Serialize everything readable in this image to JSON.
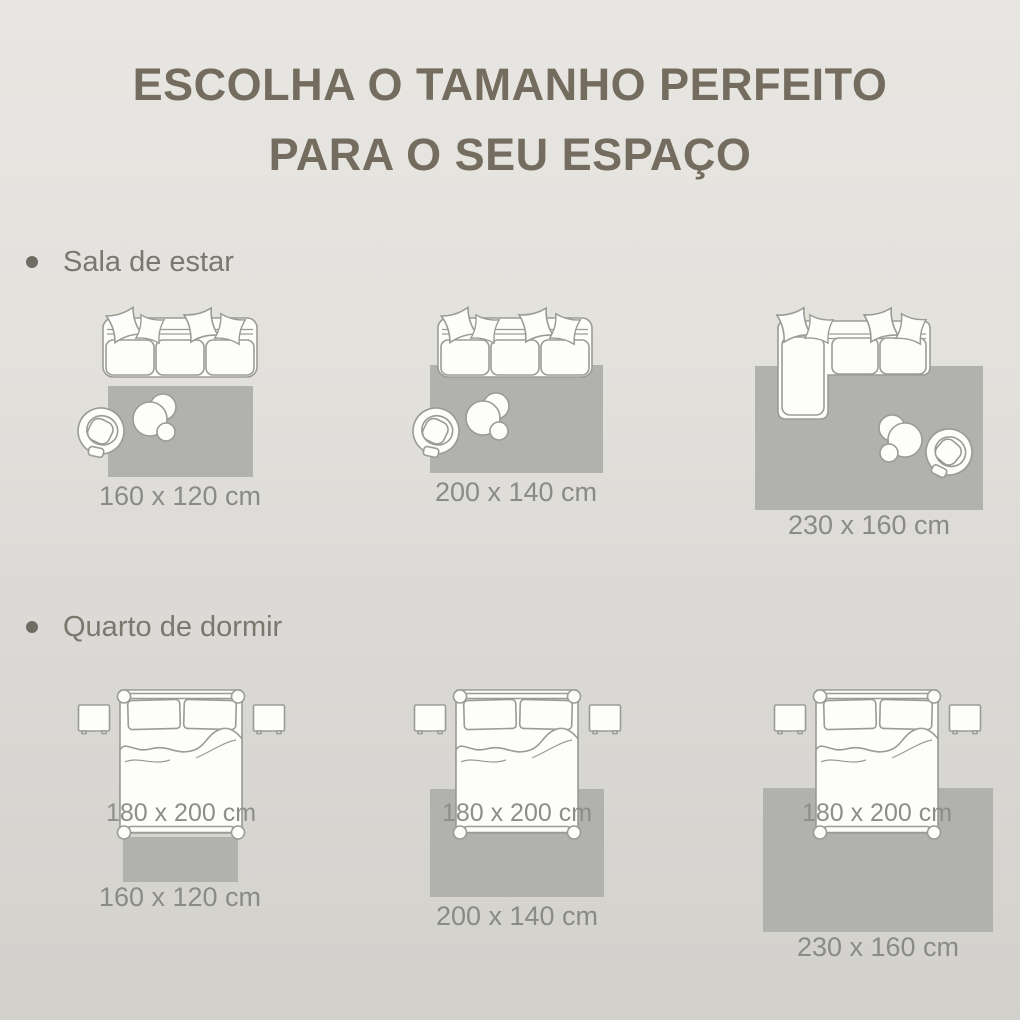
{
  "title": {
    "line1": "ESCOLHA O TAMANHO PERFEITO",
    "line2": "PARA O SEU ESPAÇO"
  },
  "sections": {
    "living_room": {
      "heading": "Sala de estar",
      "options": [
        {
          "rug_size": "160 x 120 cm"
        },
        {
          "rug_size": "200 x 140 cm"
        },
        {
          "rug_size": "230 x 160 cm"
        }
      ]
    },
    "bedroom": {
      "heading": "Quarto de dormir",
      "bed_size": "180 x 200 cm",
      "options": [
        {
          "rug_size": "160 x 120 cm"
        },
        {
          "rug_size": "200 x 140 cm"
        },
        {
          "rug_size": "230 x 160 cm"
        }
      ]
    }
  },
  "colors": {
    "background_top": "#e8e6e2",
    "background_bottom": "#d3d1cc",
    "rug": "#b1b2ad",
    "furniture_outline": "#9b9b96",
    "title_text": "#746c5e",
    "label_text": "#8a8a87"
  }
}
